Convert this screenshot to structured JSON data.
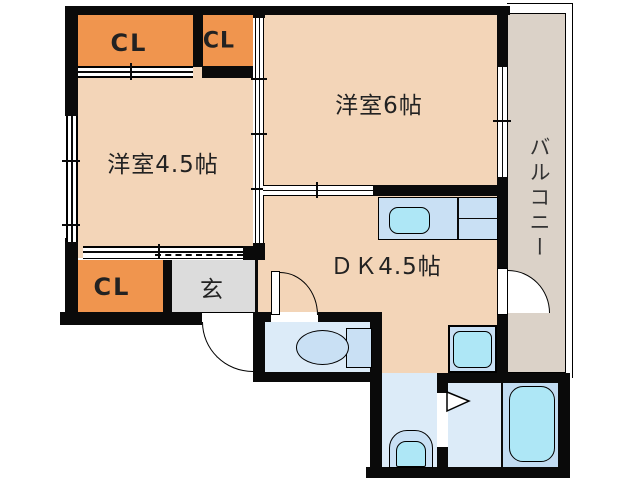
{
  "plan": {
    "title": "1DK apartment floor plan",
    "labels": {
      "room_6": "洋室6帖",
      "room_45": "洋室4.5帖",
      "dk": "ＤＫ4.5帖",
      "closet_1": "CL",
      "closet_2": "CL",
      "closet_3": "CL",
      "entrance": "玄",
      "balcony": "バルコニー"
    },
    "colors": {
      "wall": "#0a0a0a",
      "room_fill": "#F3D5B8",
      "closet_fill": "#F0954E",
      "entrance_fill": "#DCDCDC",
      "balcony_fill": "#DBD2C8",
      "wet_room_fill": "#DCEBF8",
      "bath_zone_fill": "#C2DCF2",
      "fixture_fill": "#C9E0F4",
      "water_fill": "#AEE7F6"
    },
    "fixtures": [
      "kitchen-sink",
      "toilet",
      "washbasin",
      "bathtub",
      "washing-machine-pan"
    ]
  }
}
